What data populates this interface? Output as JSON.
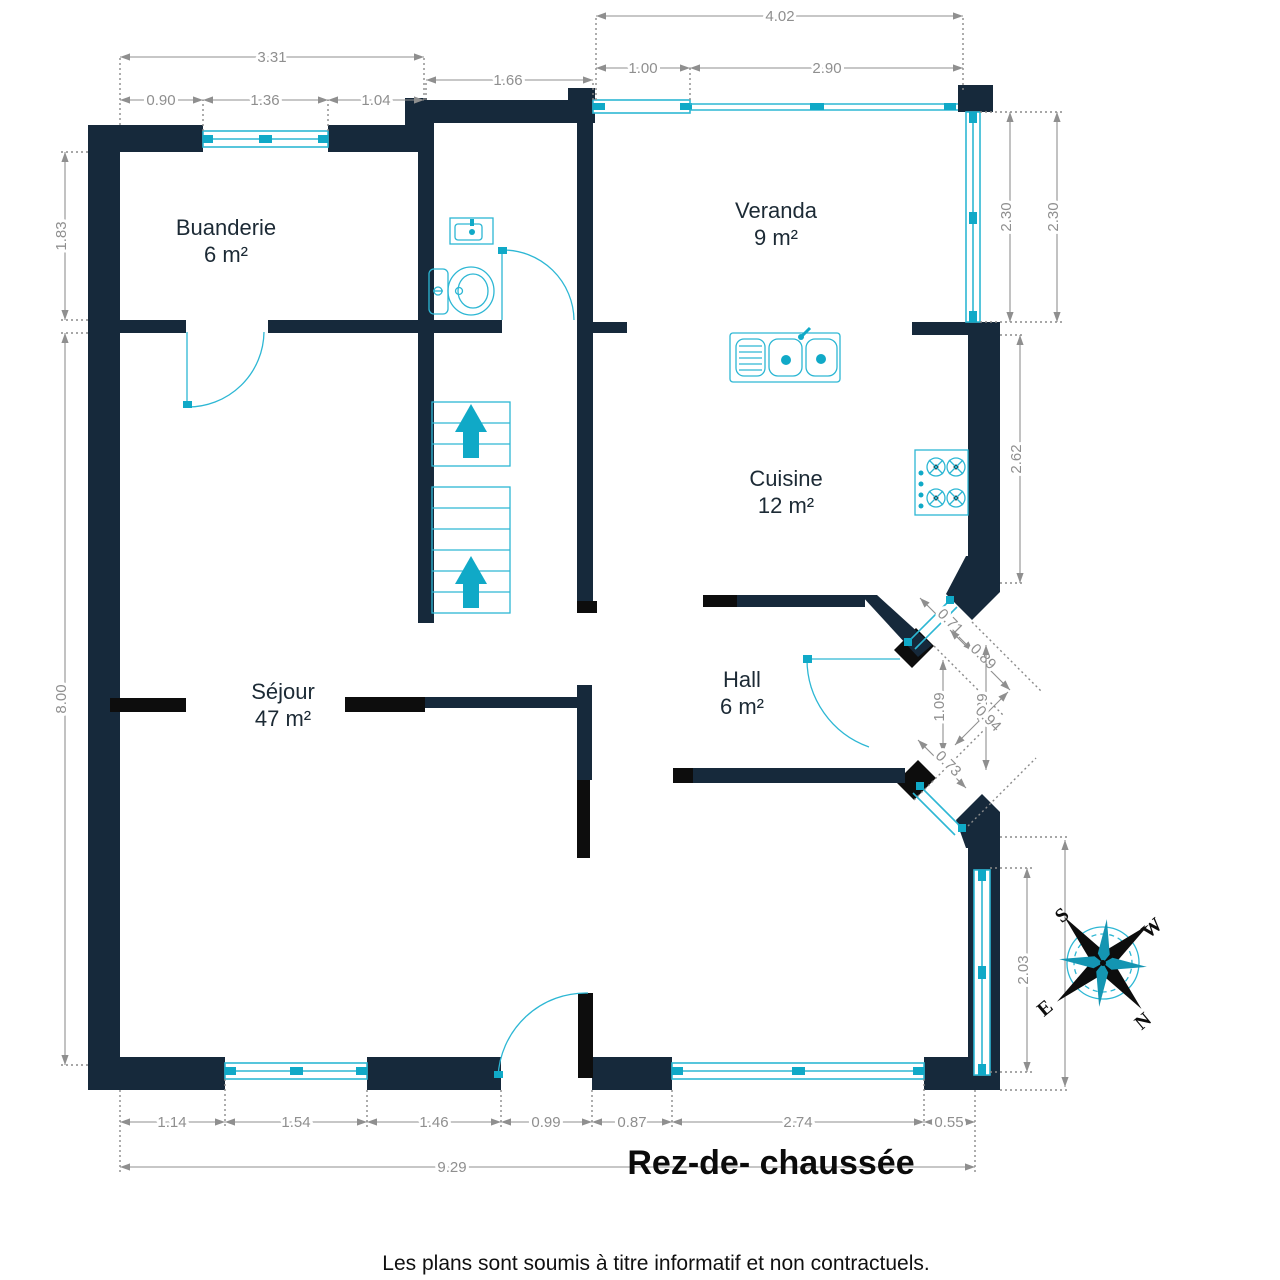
{
  "title": "Rez-de- chaussée",
  "footer": "Les plans sont soumis à titre informatif et non contractuels.",
  "rooms": {
    "buanderie": {
      "name": "Buanderie",
      "area": "6 m²"
    },
    "veranda": {
      "name": "Veranda",
      "area": "9 m²"
    },
    "cuisine": {
      "name": "Cuisine",
      "area": "12 m²"
    },
    "sejour": {
      "name": "Séjour",
      "area": "47 m²"
    },
    "hall": {
      "name": "Hall",
      "area": "6 m²"
    }
  },
  "dims": {
    "d331": "3.31",
    "d090": "0.90",
    "d136": "1.36",
    "d104": "1.04",
    "d166": "1.66",
    "d402": "4.02",
    "d100": "1.00",
    "d290": "2.90",
    "d183": "1.83",
    "d800": "8.00",
    "d230a": "2.30",
    "d230b": "2.30",
    "d262": "2.62",
    "d071": "0.71",
    "d089": "0.89",
    "d109": "1.09",
    "d129": "1.29",
    "d094": "0.94",
    "d073": "0.73",
    "d203": "2.03",
    "d114": "1.14",
    "d154": "1.54",
    "d146": "1.46",
    "d099": "0.99",
    "d087": "0.87",
    "d274": "2.74",
    "d055": "0.55",
    "d929": "9.29"
  },
  "compass": {
    "n": "N",
    "e": "E",
    "s": "S",
    "w": "W"
  },
  "icons": [
    "stairs-up-arrow-icon",
    "toilet-icon",
    "washbasin-icon",
    "kitchen-sink-icon",
    "stove-icon",
    "compass-rose-icon"
  ],
  "colors": {
    "wall": "#16293b",
    "wall_black": "#0d0d0d",
    "fixture": "#2db7d4",
    "fixture_solid": "#10a9c7",
    "dimension": "#8f8f8f"
  }
}
